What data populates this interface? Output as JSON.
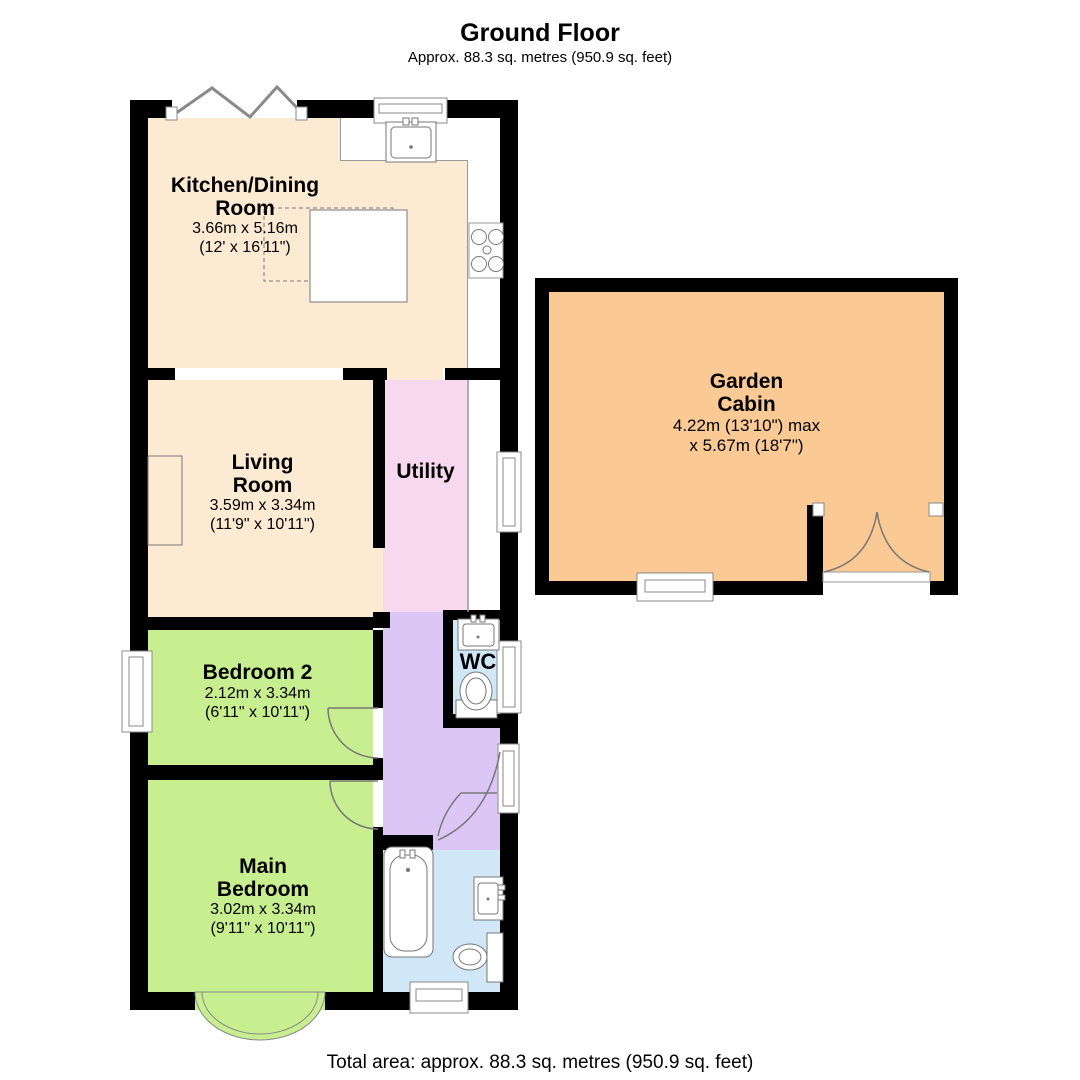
{
  "header": {
    "title": "Ground Floor",
    "subtitle": "Approx. 88.3 sq. metres (950.9 sq. feet)"
  },
  "footer": {
    "text": "Total area: approx. 88.3 sq. metres (950.9 sq. feet)"
  },
  "colors": {
    "wall": "#000000",
    "kitchen_living": "#FCEBD2",
    "bedroom": "#C7EF8F",
    "utility": "#F8D8EF",
    "hall": "#DCC6F5",
    "bathroom": "#CFE7F7",
    "cabin": "#FBC994",
    "outline": "#777777"
  },
  "rooms": {
    "kitchen": {
      "name_line1": "Kitchen/Dining",
      "name_line2": "Room",
      "dims_metric": "3.66m x 5.16m",
      "dims_imperial": "(12' x 16'11\")"
    },
    "living": {
      "name_line1": "Living",
      "name_line2": "Room",
      "dims_metric": "3.59m x 3.34m",
      "dims_imperial": "(11'9\" x 10'11\")"
    },
    "utility": {
      "name": "Utility"
    },
    "garden_cabin": {
      "name_line1": "Garden",
      "name_line2": "Cabin",
      "dims_line1": "4.22m (13'10\") max",
      "dims_line2": "x 5.67m (18'7\")"
    },
    "bedroom2": {
      "name": "Bedroom 2",
      "dims_metric": "2.12m x 3.34m",
      "dims_imperial": "(6'11\" x 10'11\")"
    },
    "wc": {
      "name": "WC"
    },
    "main_bedroom": {
      "name_line1": "Main",
      "name_line2": "Bedroom",
      "dims_metric": "3.02m x 3.34m",
      "dims_imperial": "(9'11\" x 10'11\")"
    }
  }
}
